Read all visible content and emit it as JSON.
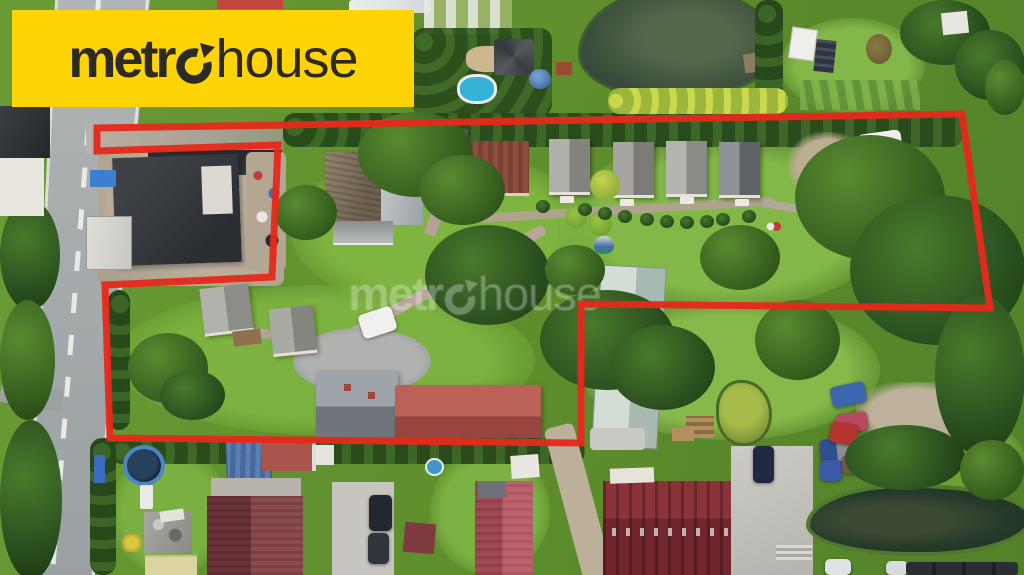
{
  "colors": {
    "boundary-red": "#e52a1c",
    "logo-yellow": "#ffd405",
    "logo-dark": "#2d2a24",
    "grass-base": "#6a9a35",
    "grass-light": "#84b647",
    "veg-dark": "#2f5220",
    "road-gray": "#a7acae",
    "path-tan": "#b3a294",
    "dirt-tan": "#c0b3a0",
    "roof-dark": "#34373c",
    "roof-gray": "#909694",
    "roof-red": "#a9544e",
    "roof-maroon": "#7d3a40",
    "barn-metal": "#c3cfc9",
    "water-dark": "#41553e",
    "water-pond": "#26392a",
    "concrete": "#c7c6c0"
  },
  "logo": {
    "text_bold": "metr",
    "icon": "o-with-up-right-arrow",
    "text_light": "house"
  },
  "watermark": {
    "text_bold": "metr",
    "icon": "o-with-up-right-arrow",
    "text_light": "house"
  },
  "boundary": {
    "points": "97,128 962,114 990,308 581,304 581,443 110,438 105,285 272,277 278,145 97,151",
    "color": "#e52a1c",
    "stroke_width": 7
  },
  "scene": {
    "type": "aerial-drone-photo",
    "subject": "village plots with red property-boundary overlay",
    "features": [
      "asphalt-road",
      "road-center-dashes",
      "road-edge-lines",
      "roadside-trees",
      "white-building-top-left",
      "neighbor-dark-roof-house",
      "neighbor-white-shed",
      "dirt-yard",
      "access-corridor-gravel",
      "top-hedge-row",
      "yellow-green-hedge",
      "upper-pond",
      "wooden-dock",
      "garden-gazebo",
      "blue-pool",
      "dome-tent",
      "white-caravans",
      "old-shingle-house",
      "gray-roof-extension",
      "dark-gray-barn",
      "red-brown-barn",
      "cottage-row-4",
      "picnic-tables",
      "ornamental-bushes",
      "brick-paths",
      "gravel-patch",
      "white-van",
      "parked-dark-cars",
      "lawn",
      "interior-trees",
      "cul-de-sac",
      "white-car",
      "small-cabins-lower-left",
      "gray-gable-house",
      "red-roof-house",
      "long-metal-barn",
      "green-pond",
      "wood-stack",
      "blue-car",
      "pink-car",
      "blue-truck",
      "bottom-hedge-row",
      "trampoline",
      "blue-mat",
      "junk-trailer",
      "beige-building",
      "blue-shed",
      "maroon-roof-house",
      "pink-roof-house",
      "big-red-building",
      "skylight-row",
      "concrete-yard",
      "steps",
      "gravel-road",
      "parking-cars-bottom",
      "lower-pond",
      "reeds"
    ]
  }
}
